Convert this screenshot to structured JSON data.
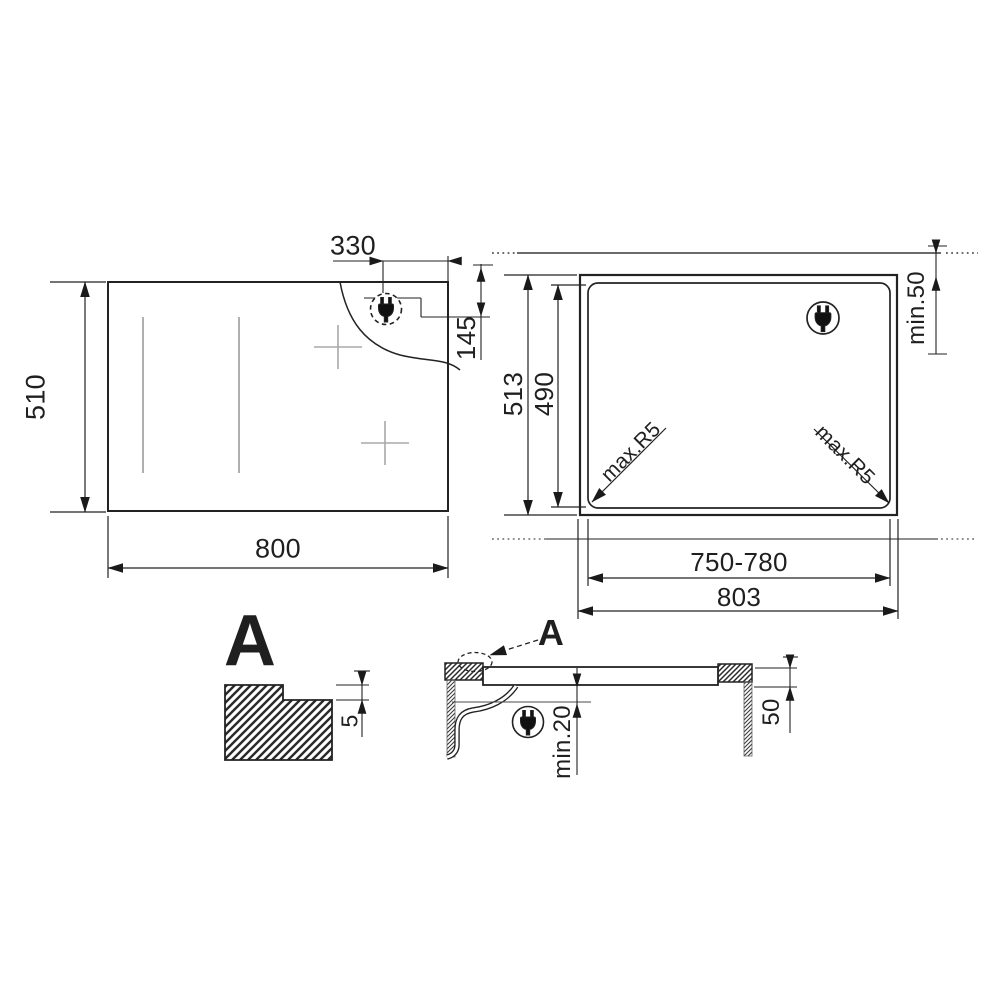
{
  "diagram": {
    "title": "hob-installation-drawing",
    "top_view": {
      "width_label": "800",
      "height_label": "510",
      "plug_offset_label": "330",
      "plug_depth_label": "145",
      "plug_icon": "power-plug-icon"
    },
    "cutout_view": {
      "outer_height_label": "513",
      "cutout_height_label": "490",
      "wall_clearance_label": "min.50",
      "cutout_width_label": "750-780",
      "outer_width_label": "803",
      "corner_radius_left_label": "max.R5",
      "corner_radius_right_label": "max.R5",
      "plug_icon": "power-plug-icon"
    },
    "detail_a": {
      "title": "A",
      "step_depth_label": "5"
    },
    "side_view": {
      "detail_ref_label": "A",
      "clearance_below_label": "min.20",
      "side_clearance_label": "50",
      "plug_icon": "power-plug-icon"
    },
    "colors": {
      "line": "#222222",
      "dim_line": "#2a2a2a",
      "light_line": "#9a9a9a",
      "background": "#ffffff"
    }
  }
}
